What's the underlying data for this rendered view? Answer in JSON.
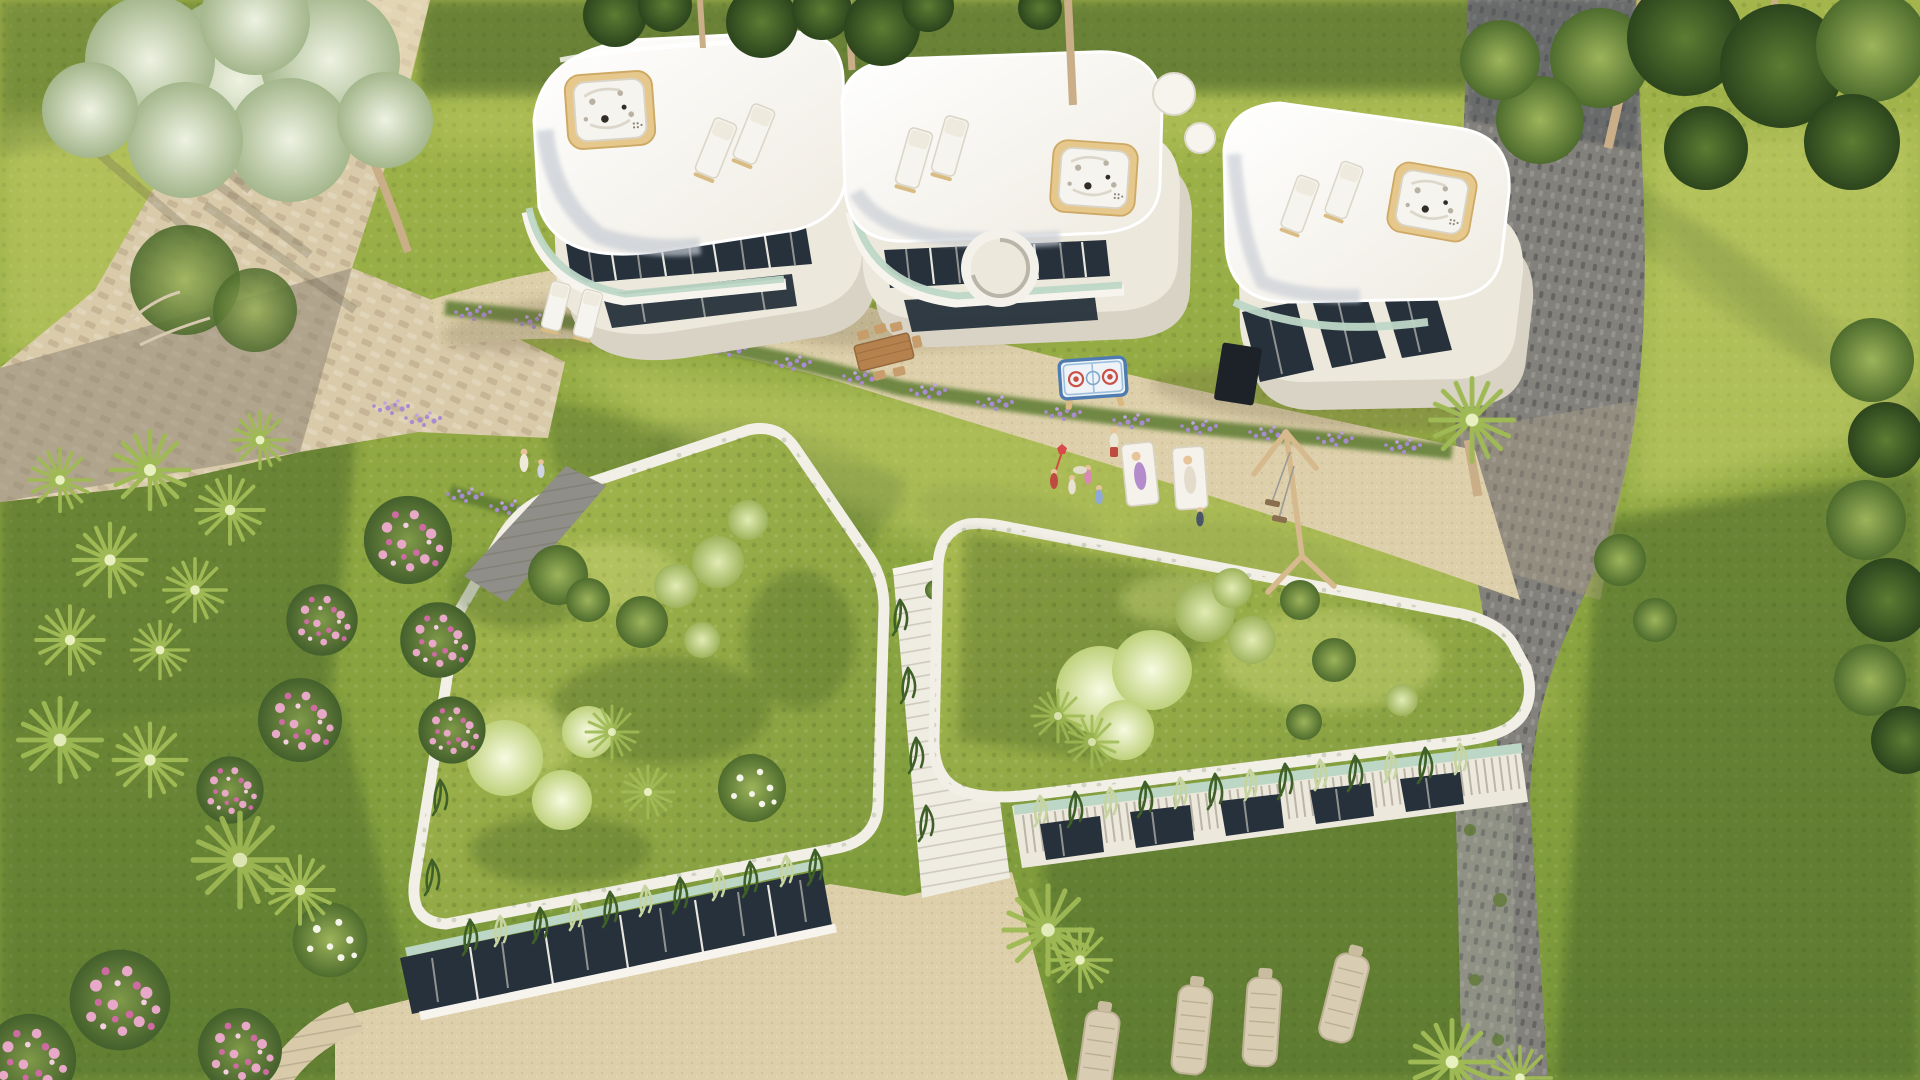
{
  "scene": {
    "type": "architectural-aerial-render",
    "description": "Sunny aerial 3D rendering of a luxury villa complex: three curved white villas with rooftop jacuzzis and sun loungers along the top, a stone driveway and cobble paths, a shared sunlit lawn with children playing, two occupied sun loungers, an air-hockey table and a wooden swing set, and two green-roofed garden buildings below with fluffy shrubs, cascading plants and a central stair, surrounded by olive trees, palms, dragon trees, pink rose bushes and lavender beds.",
    "time_of_day": "sunny daylight",
    "view": "top-down oblique aerial"
  },
  "palette": {
    "lawn_sun": "#b7c257",
    "lawn_mid": "#8ea33f",
    "lawn_shade": "#54702c",
    "stone_light": "#d9cbaa",
    "stone_shade": "#a29682",
    "cobble_dark": "#83817b",
    "sand": "#dccfa9",
    "villa_white": "#f7f4ed",
    "villa_cream": "#ece8db",
    "villa_shadow": "#d8d3c5",
    "roof_sheen": "#c7ccd4",
    "glass_dark": "#26313c",
    "curtain": "#e9e4d8",
    "mint": "#bdd7c6",
    "wood": "#e7c88c",
    "wood_dark": "#c9a368",
    "tree_dark": "#2f4a1f",
    "tree_mid": "#567931",
    "tree_silver": "#c7d4b4",
    "bush_fluffy": "#e9f1c6",
    "pink": "#e39ec2",
    "pink_deep": "#cf6ba3",
    "lavender": "#a98bd1",
    "trunk": "#c9ae88",
    "swing_wood": "#d6b98c",
    "wall_grey": "#8e9183",
    "people_red": "#bf4a42"
  },
  "objects": {
    "villas": [
      "villa-left",
      "villa-middle",
      "villa-right"
    ],
    "jacuzzi_count": 3,
    "rooftop_lounger_count": 6,
    "terrace_lounger_count": 2,
    "lawn_lounger_count": 2,
    "wicker_lounger_count": 4,
    "green_roof_buildings": [
      "garden-roof-left",
      "garden-roof-right"
    ],
    "play_equipment": [
      "air-hockey-table",
      "swing-set"
    ],
    "furniture": [
      "outdoor-dining-set"
    ],
    "people_count": 10,
    "vegetation": [
      "olive-tree",
      "pine-canopies",
      "dragon-trees",
      "palms",
      "sago-palm",
      "pink-rose-bushes",
      "white-flower-bush",
      "lavender-beds",
      "hedge"
    ]
  }
}
